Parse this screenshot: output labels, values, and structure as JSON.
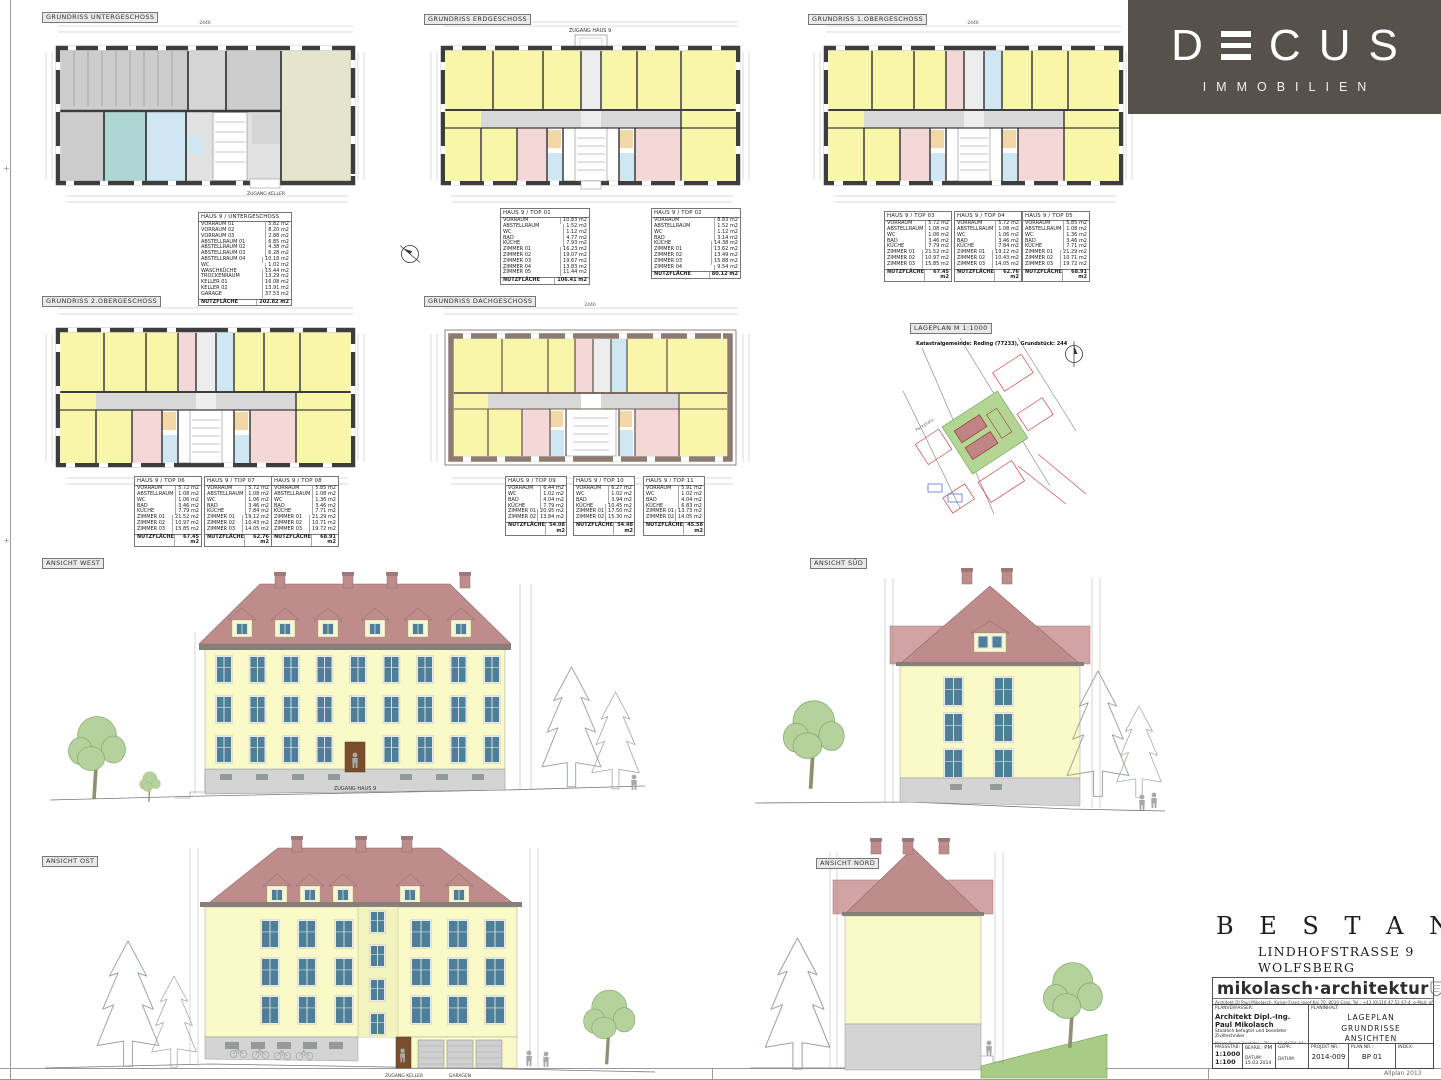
{
  "logo": {
    "brand_d": "D",
    "brand_rest_c": "C",
    "brand_rest_u": "U",
    "brand_rest_s": "S",
    "sub": "IMMOBILIEN"
  },
  "colors": {
    "wall": "#3d3d3d",
    "room_yellow": "#f7f6a9",
    "room_gray": "#d8d8d8",
    "room_pink": "#f4d7d7",
    "room_blue": "#cfe7f2",
    "room_teal": "#aed6d4",
    "room_orange": "#f2d8a6",
    "room_beige": "#e5e5cb",
    "roof_red": "#bf8c8c",
    "roof_light": "#d2a3a3",
    "facade_yellow": "#fafac9",
    "base_gray": "#d4d4d4",
    "window_glass": "#4d7f99",
    "window_frame": "#e9e9e9",
    "door_brown": "#7a4e2d",
    "tree_green": "#b5d29c",
    "ground_green": "#a8cc85",
    "logo_bg": "#56514b",
    "map_red": "#cc4444",
    "map_blue": "#4a5fc0",
    "map_green": "#b3d695"
  },
  "plans": {
    "untergeschoss": {
      "title": "GRUNDRISS UNTERGESCHOSS",
      "cellar_label": "ZUGANG KELLER",
      "dim_total": "2446"
    },
    "erdgeschoss": {
      "title": "GRUNDRISS ERDGESCHOSS",
      "entry_label": "ZUGANG HAUS 9",
      "dim_total": "2446"
    },
    "og1": {
      "title": "GRUNDRISS 1.OBERGESCHOSS",
      "dim_total": "2446"
    },
    "og2": {
      "title": "GRUNDRISS 2.OBERGESCHOSS",
      "dim_total": "2446"
    },
    "dach": {
      "title": "GRUNDRISS DACHGESCHOSS",
      "dim_total": "2446"
    }
  },
  "lageplan": {
    "title": "LAGEPLAN   M 1:1000",
    "subtitle": "Katastralgemeinde: Reding (77233), Grundstück: 244",
    "note": "Parkplatz"
  },
  "tables": {
    "ug": {
      "title": "HAUS 9 / UNTERGESCHOSS",
      "rows": [
        [
          "VORRAUM 01",
          "5.82 m2"
        ],
        [
          "VORRAUM 02",
          "8.20 m2"
        ],
        [
          "VORRAUM 03",
          "2.88 m2"
        ],
        [
          "ABSTELLRAUM 01",
          "6.85 m2"
        ],
        [
          "ABSTELLRAUM 02",
          "4.38 m2"
        ],
        [
          "ABSTELLRAUM 03",
          "6.28 m2"
        ],
        [
          "ABSTELLRAUM 04",
          "10.18 m2"
        ],
        [
          "WC",
          "1.02 m2"
        ],
        [
          "WASCHKÜCHE",
          "15.44 m2"
        ],
        [
          "TROCKENRAUM",
          "13.29 m2"
        ],
        [
          "KELLER 01",
          "16.08 m2"
        ],
        [
          "KELLER 02",
          "13.91 m2"
        ],
        [
          "GARAGE",
          "37.53 m2"
        ]
      ],
      "total": [
        "NUTZFLÄCHE",
        "202.82 m2"
      ]
    },
    "top01": {
      "title": "HAUS 9 / TOP 01",
      "rows": [
        [
          "VORRAUM",
          "10.83 m2"
        ],
        [
          "ABSTELLRAUM",
          "1.52 m2"
        ],
        [
          "WC",
          "1.12 m2"
        ],
        [
          "BAD",
          "4.77 m2"
        ],
        [
          "KÜCHE",
          "7.93 m2"
        ],
        [
          "ZIMMER 01",
          "16.23 m2"
        ],
        [
          "ZIMMER 02",
          "19.07 m2"
        ],
        [
          "ZIMMER 03",
          "19.67 m2"
        ],
        [
          "ZIMMER 04",
          "13.83 m2"
        ],
        [
          "ZIMMER 05",
          "11.44 m2"
        ]
      ],
      "total": [
        "NUTZFLÄCHE",
        "106.41 m2"
      ]
    },
    "top02": {
      "title": "HAUS 9 / TOP 02",
      "rows": [
        [
          "VORRAUM",
          "8.83 m2"
        ],
        [
          "ABSTELLRAUM",
          "1.52 m2"
        ],
        [
          "WC",
          "1.12 m2"
        ],
        [
          "BAD",
          "3.14 m2"
        ],
        [
          "KÜCHE",
          "14.38 m2"
        ],
        [
          "ZIMMER 01",
          "13.62 m2"
        ],
        [
          "ZIMMER 02",
          "13.49 m2"
        ],
        [
          "ZIMMER 03",
          "15.88 m2"
        ],
        [
          "ZIMMER 04",
          "9.54 m2"
        ]
      ],
      "total": [
        "NUTZFLÄCHE",
        "80.12 m2"
      ]
    },
    "top03": {
      "title": "HAUS 9 / TOP 03",
      "rows": [
        [
          "VORRAUM",
          "5.72 m2"
        ],
        [
          "ABSTELLRAUM",
          "1.08 m2"
        ],
        [
          "WC",
          "1.06 m2"
        ],
        [
          "BAD",
          "3.46 m2"
        ],
        [
          "KÜCHE",
          "7.79 m2"
        ],
        [
          "ZIMMER 01",
          "21.52 m2"
        ],
        [
          "ZIMMER 02",
          "10.97 m2"
        ],
        [
          "ZIMMER 03",
          "15.85 m2"
        ]
      ],
      "total": [
        "NUTZFLÄCHE",
        "67.45 m2"
      ]
    },
    "top04": {
      "title": "HAUS 9 / TOP 04",
      "rows": [
        [
          "VORRAUM",
          "5.72 m2"
        ],
        [
          "ABSTELLRAUM",
          "1.08 m2"
        ],
        [
          "WC",
          "1.06 m2"
        ],
        [
          "BAD",
          "3.46 m2"
        ],
        [
          "KÜCHE",
          "7.84 m2"
        ],
        [
          "ZIMMER 01",
          "19.12 m2"
        ],
        [
          "ZIMMER 02",
          "10.43 m2"
        ],
        [
          "ZIMMER 03",
          "14.05 m2"
        ]
      ],
      "total": [
        "NUTZFLÄCHE",
        "62.76 m2"
      ]
    },
    "top05": {
      "title": "HAUS 9 / TOP 05",
      "rows": [
        [
          "VORRAUM",
          "5.85 m2"
        ],
        [
          "ABSTELLRAUM",
          "1.08 m2"
        ],
        [
          "WC",
          "1.36 m2"
        ],
        [
          "BAD",
          "3.46 m2"
        ],
        [
          "KÜCHE",
          "7.71 m2"
        ],
        [
          "ZIMMER 01",
          "21.29 m2"
        ],
        [
          "ZIMMER 02",
          "10.71 m2"
        ],
        [
          "ZIMMER 03",
          "19.72 m2"
        ]
      ],
      "total": [
        "NUTZFLÄCHE",
        "68.91 m2"
      ]
    },
    "top06": {
      "title": "HAUS 9 / TOP 06",
      "rows": [
        [
          "VORRAUM",
          "5.72 m2"
        ],
        [
          "ABSTELLRAUM",
          "1.08 m2"
        ],
        [
          "WC",
          "1.06 m2"
        ],
        [
          "BAD",
          "3.46 m2"
        ],
        [
          "KÜCHE",
          "7.79 m2"
        ],
        [
          "ZIMMER 01",
          "21.52 m2"
        ],
        [
          "ZIMMER 02",
          "10.97 m2"
        ],
        [
          "ZIMMER 03",
          "15.85 m2"
        ]
      ],
      "total": [
        "NUTZFLÄCHE",
        "67.45 m2"
      ]
    },
    "top07": {
      "title": "HAUS 9 / TOP 07",
      "rows": [
        [
          "VORRAUM",
          "5.72 m2"
        ],
        [
          "ABSTELLRAUM",
          "1.08 m2"
        ],
        [
          "WC",
          "1.06 m2"
        ],
        [
          "BAD",
          "3.46 m2"
        ],
        [
          "KÜCHE",
          "7.84 m2"
        ],
        [
          "ZIMMER 01",
          "19.12 m2"
        ],
        [
          "ZIMMER 02",
          "10.43 m2"
        ],
        [
          "ZIMMER 03",
          "14.05 m2"
        ]
      ],
      "total": [
        "NUTZFLÄCHE",
        "62.76 m2"
      ]
    },
    "top08": {
      "title": "HAUS 9 / TOP 08",
      "rows": [
        [
          "VORRAUM",
          "5.85 m2"
        ],
        [
          "ABSTELLRAUM",
          "1.08 m2"
        ],
        [
          "WC",
          "1.36 m2"
        ],
        [
          "BAD",
          "3.46 m2"
        ],
        [
          "KÜCHE",
          "7.71 m2"
        ],
        [
          "ZIMMER 01",
          "21.29 m2"
        ],
        [
          "ZIMMER 02",
          "10.71 m2"
        ],
        [
          "ZIMMER 03",
          "19.72 m2"
        ]
      ],
      "total": [
        "NUTZFLÄCHE",
        "68.91 m2"
      ]
    },
    "top09": {
      "title": "HAUS 9 / TOP 09",
      "rows": [
        [
          "VORRAUM",
          "6.44 m2"
        ],
        [
          "WC",
          "1.02 m2"
        ],
        [
          "BAD",
          "4.04 m2"
        ],
        [
          "KÜCHE",
          "7.79 m2"
        ],
        [
          "ZIMMER 01",
          "20.95 m2"
        ],
        [
          "ZIMMER 02",
          "13.84 m2"
        ]
      ],
      "total": [
        "NUTZFLÄCHE",
        "54.08 m2"
      ]
    },
    "top10": {
      "title": "HAUS 9 / TOP 10",
      "rows": [
        [
          "VORRAUM",
          "6.27 m2"
        ],
        [
          "WC",
          "1.02 m2"
        ],
        [
          "BAD",
          "3.94 m2"
        ],
        [
          "KÜCHE",
          "10.45 m2"
        ],
        [
          "ZIMMER 01",
          "17.50 m2"
        ],
        [
          "ZIMMER 02",
          "15.30 m2"
        ]
      ],
      "total": [
        "NUTZFLÄCHE",
        "54.48 m2"
      ]
    },
    "top11": {
      "title": "HAUS 9 / TOP 11",
      "rows": [
        [
          "VORRAUM",
          "5.91 m2"
        ],
        [
          "WC",
          "1.02 m2"
        ],
        [
          "BAD",
          "4.04 m2"
        ],
        [
          "KÜCHE",
          "6.83 m2"
        ],
        [
          "ZIMMER 01",
          "13.73 m2"
        ],
        [
          "ZIMMER 02",
          "14.05 m2"
        ]
      ],
      "total": [
        "NUTZFLÄCHE",
        "45.58 m2"
      ]
    }
  },
  "elevations": {
    "west": {
      "label": "ANSICHT WEST",
      "entry": "ZUGANG HAUS 9"
    },
    "sued": {
      "label": "ANSICHT SÜD"
    },
    "ost": {
      "label": "ANSICHT OST",
      "zugang_keller": "ZUGANG KELLER",
      "garagen": "GARAGEN"
    },
    "nord": {
      "label": "ANSICHT NORD"
    }
  },
  "titleblock": {
    "main_title": "B E S T A N D S P L A N",
    "address1": "LINDHOFSTRASSE 9",
    "address2": "WOLFSBERG",
    "studio_logo": "mikolasch·architektur",
    "studio_contact": "Architekt DI Paul Mikolasch, Kaiser-Franz-Josef-Kai 70, 8010 Graz, Tel.: +43 (0)316 47 51 47-4, e-Mail: office@mikolasch-architektur.at, Homepage: www.mikolasch-architektur.at",
    "planverfasser_label": "PLANVERFASSER:",
    "planinhalt_label": "PLANINHALT:",
    "architect_name": "Architekt Dipl.-Ing. Paul Mikolasch",
    "architect_sub": "Staatlich befugter und beeideter Ziviltechniker",
    "addr1": "Kaiser-Franz-Josef-Kai 70",
    "addr2": "8010 Graz",
    "addr3": "office@mikolasch-architektur.at",
    "tel": "Tel.: +43 (0)316 47 51 47-4",
    "fax": "Fax: +43 (0)316 25 72 63-4",
    "web": "www.mikolasch-architektur.at",
    "planinhalt": [
      "LAGEPLAN",
      "GRUNDRISSE",
      "ANSICHTEN"
    ],
    "massstab_label": "MASSSTAB:",
    "massstab1": "1:1000",
    "massstab2": "1:100",
    "bearb_label": "BEARB.:",
    "bearb": "PM",
    "gepr_label": "GEPR.:",
    "datum_label": "DATUM:",
    "datum": "15.03.2014",
    "projekt_label": "PROJEKT NR.:",
    "projekt": "2014-009",
    "plannr_label": "PLAN NR.:",
    "plannr": "BP 01",
    "index_label": "INDEX:",
    "allplan": "Allplan 2013"
  }
}
